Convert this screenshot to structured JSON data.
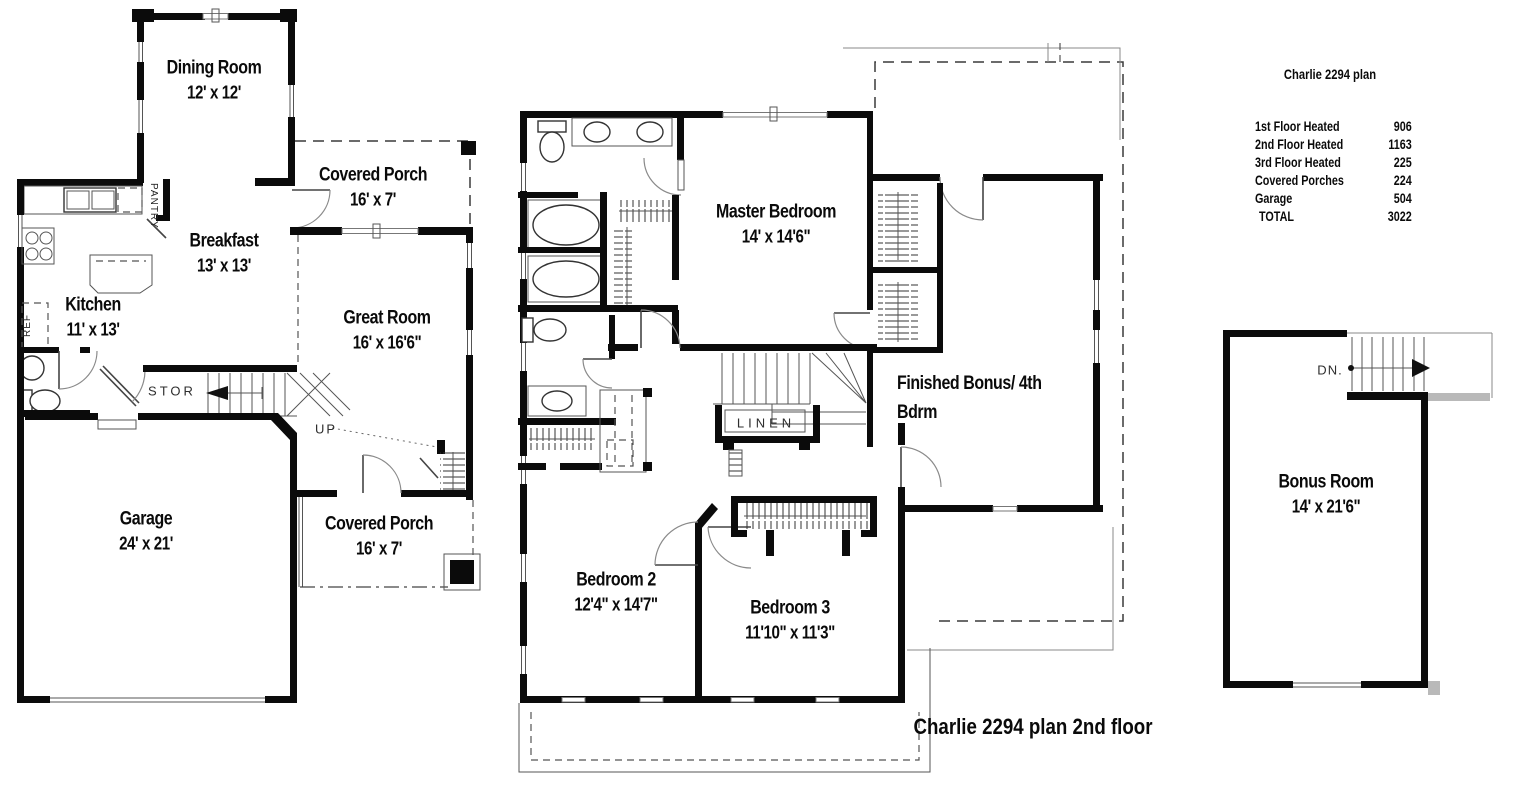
{
  "first_floor": {
    "rooms": {
      "dining": {
        "name": "Dining Room",
        "dims": "12' x 12'"
      },
      "porch_top": {
        "name": "Covered Porch",
        "dims": "16' x 7'"
      },
      "breakfast": {
        "name": "Breakfast",
        "dims": "13' x 13'"
      },
      "kitchen": {
        "name": "Kitchen",
        "dims": "11' x 13'"
      },
      "great_room": {
        "name": "Great Room",
        "dims": "16' x 16'6\""
      },
      "garage": {
        "name": "Garage",
        "dims": "24' x 21'"
      },
      "porch_bottom": {
        "name": "Covered Porch",
        "dims": "16' x 7'"
      }
    },
    "annotations": {
      "pantry": "PANTRY",
      "ref": "REF",
      "stor": "STOR",
      "up": "UP"
    }
  },
  "second_floor": {
    "rooms": {
      "master": {
        "name": "Master Bedroom",
        "dims": "14' x 14'6\""
      },
      "bonus": {
        "line1": "Finished Bonus/ 4th",
        "line2": "Bdrm"
      },
      "bedroom2": {
        "name": "Bedroom 2",
        "dims": "12'4\" x 14'7\""
      },
      "bedroom3": {
        "name": "Bedroom 3",
        "dims": "11'10\" x 11'3\""
      }
    },
    "annotations": {
      "linen": "LINEN"
    },
    "caption": "Charlie 2294 plan 2nd floor"
  },
  "third_floor": {
    "rooms": {
      "bonus_room": {
        "name": "Bonus Room",
        "dims": "14' x 21'6\""
      }
    },
    "annotations": {
      "down": "DN."
    }
  },
  "summary": {
    "title": "Charlie 2294 plan",
    "rows": [
      {
        "label": "1st Floor Heated",
        "value": "906"
      },
      {
        "label": "2nd Floor Heated",
        "value": "1163"
      },
      {
        "label": "3rd Floor Heated",
        "value": "225"
      },
      {
        "label": "Covered Porches",
        "value": "224"
      },
      {
        "label": "Garage",
        "value": "504"
      },
      {
        "label": "TOTAL",
        "value": "3022"
      }
    ]
  },
  "colors": {
    "wall": "#0b0b0b",
    "background": "#ffffff"
  }
}
